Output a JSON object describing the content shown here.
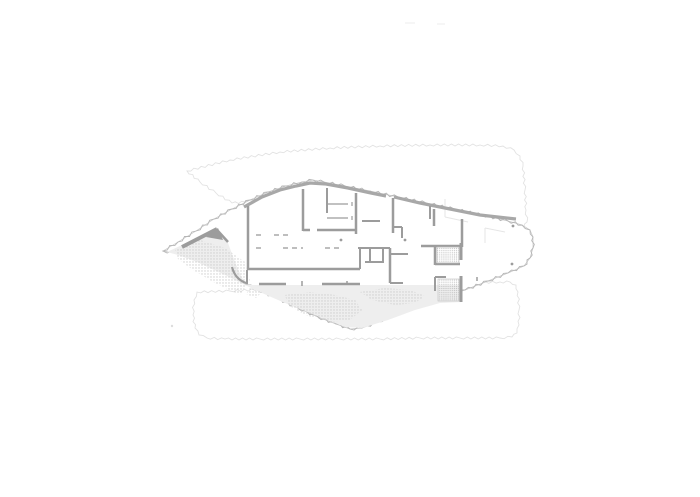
{
  "scene": {
    "kind": "architectural-floor-plan",
    "description": "Light gray line drawing of a floor plan: organically shaped building slab with serrated insulation perimeter, interior partition walls, dashed furniture lines, stippled terrain patches, hatched shaft rooms, small column dots, and very faint outlines of the floor plates above and below.",
    "elements": [
      "upper-floor-ghost-outline",
      "lower-floor-ghost-outline",
      "building-perimeter",
      "terrace-fill",
      "terrain-stipple-patches",
      "interior-walls",
      "dashed-furniture-lines",
      "hatched-shaft-rooms",
      "column-dots",
      "ghost-wall-traces",
      "stray-plot-marks"
    ],
    "colors": {
      "background": "#ffffff",
      "wall": "#9c9c9c",
      "wall_light": "#a8a8a8",
      "perimeter": "#b5b5b5",
      "perimeter_inner": "#c8c8c8",
      "ghost_outline": "#e2e2e2",
      "ghost_trace": "#e6e6e6",
      "terrace": "#eeeeee",
      "stipple": "#c9c9c9",
      "hatch": "#bfbfbf",
      "mark": "#dddddd"
    }
  }
}
